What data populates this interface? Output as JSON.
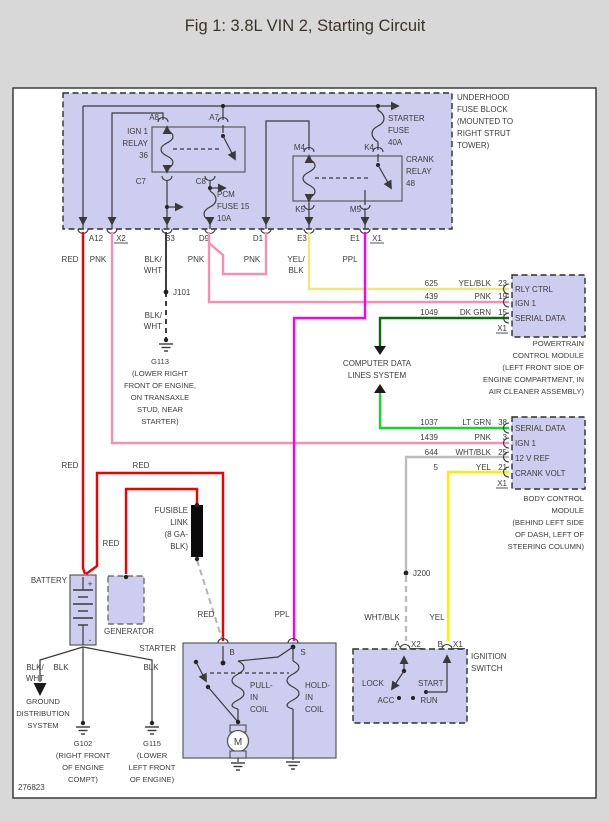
{
  "title": "Fig 1: 3.8L VIN 2, Starting Circuit",
  "doc_number": "276823",
  "colors": {
    "red": "#f20000",
    "pink": "#f78fb2",
    "magenta": "#fb00f0",
    "pale_yellow": "#efe878",
    "yellow": "#ffec00",
    "dark_green": "#0c6b0c",
    "light_green": "#15d42a",
    "white_black": "#bdbdbd",
    "black_wire": "#3d3d3d",
    "module_fill": "#cdcdf0"
  },
  "fuse_block": {
    "name_lines": [
      "UNDERHOOD",
      "FUSE BLOCK",
      "(MOUNTED TO",
      "RIGHT STRUT",
      "TOWER)"
    ],
    "ign1_relay": {
      "label_lines": [
        "IGN 1",
        "RELAY",
        "36"
      ],
      "pins": {
        "a8": "A8",
        "a7": "A7",
        "c7": "C7",
        "c8": "C8"
      }
    },
    "pcm_fuse_lines": [
      "PCM",
      "FUSE 15",
      "10A"
    ],
    "starter_fuse_lines": [
      "STARTER",
      "FUSE",
      "40A"
    ],
    "crank_relay": {
      "label_lines": [
        "CRANK",
        "RELAY",
        "48"
      ],
      "pins": {
        "m4": "M4",
        "k4": "K4",
        "k5": "K5",
        "m5": "M5"
      }
    },
    "terminals": [
      "A12",
      "X2",
      "B3",
      "D9",
      "D1",
      "E3",
      "E1",
      "X1"
    ],
    "wire_colors": {
      "a12": "RED",
      "x2": "PNK",
      "b3": [
        "BLK/",
        "WHT"
      ],
      "d9": "PNK",
      "d1": "PNK",
      "e3": [
        "YEL/",
        "BLK"
      ],
      "e1": "PPL"
    }
  },
  "grounds": {
    "j101": "J101",
    "b3_color_lines": [
      "BLK/",
      "WHT"
    ],
    "g113_lines": [
      "G113",
      "(LOWER RIGHT",
      "FRONT OF ENGINE,",
      "ON TRANSAXLE",
      "STUD, NEAR",
      "STARTER)"
    ],
    "g102_lines": [
      "G102",
      "(RIGHT FRONT",
      "OF ENGINE",
      "COMPT)"
    ],
    "g115_lines": [
      "G115",
      "(LOWER",
      "LEFT FRONT",
      "OF ENGINE)"
    ]
  },
  "pcm": {
    "pins": [
      {
        "circuit": "625",
        "color": "YEL/BLK",
        "pin": "23",
        "label": "RLY CTRL"
      },
      {
        "circuit": "439",
        "color": "PNK",
        "pin": "19",
        "label": "IGN 1"
      },
      {
        "circuit": "1049",
        "color": "DK GRN",
        "pin": "15",
        "label": "SERIAL DATA"
      }
    ],
    "connector": "X1",
    "name_lines": [
      "POWERTRAIN",
      "CONTROL MODULE",
      "(LEFT FRONT SIDE OF",
      "ENGINE COMPARTMENT, IN",
      "AIR CLEANER ASSEMBLY)"
    ]
  },
  "bcm": {
    "pins": [
      {
        "circuit": "1037",
        "color": "LT GRN",
        "pin": "38",
        "label": "SERIAL DATA"
      },
      {
        "circuit": "1439",
        "color": "PNK",
        "pin": "3",
        "label": "IGN 1"
      },
      {
        "circuit": "644",
        "color": "WHT/BLK",
        "pin": "25",
        "label": "12 V REF"
      },
      {
        "circuit": "5",
        "color": "YEL",
        "pin": "21",
        "label": "CRANK VOLT"
      }
    ],
    "connector": "X1",
    "name_lines": [
      "BODY CONTROL",
      "MODULE",
      "(BEHIND LEFT SIDE",
      "OF DASH, LEFT OF",
      "STEERING COLUMN)"
    ]
  },
  "computer_data_lines": [
    "COMPUTER DATA",
    "LINES SYSTEM"
  ],
  "power": {
    "battery": "BATTERY",
    "plus": "+",
    "minus": "-",
    "generator": "GENERATOR",
    "fusible_link_lines": [
      "FUSIBLE",
      "LINK",
      "(8 GA-",
      "BLK)"
    ],
    "red1": "RED",
    "red2": "RED",
    "red3": "RED",
    "red4": "RED"
  },
  "starter": {
    "label": "STARTER",
    "b": "B",
    "s": "S",
    "pull_in_lines": [
      "PULL-",
      "IN",
      "COIL"
    ],
    "hold_in_lines": [
      "HOLD-",
      "IN",
      "COIL"
    ],
    "motor": "M",
    "ppl": "PPL"
  },
  "ground_dist": {
    "blk_wht_lines": [
      "BLK/",
      "WHT"
    ],
    "blk1": "BLK",
    "blk2": "BLK",
    "system_lines": [
      "GROUND",
      "DISTRIBUTION",
      "SYSTEM"
    ]
  },
  "ignition": {
    "j200": "J200",
    "wht_blk": "WHT/BLK",
    "yel": "YEL",
    "a": "A",
    "x2": "X2",
    "b": "B",
    "x1": "X1",
    "label_lines": [
      "IGNITION",
      "SWITCH"
    ],
    "positions": {
      "lock": "LOCK",
      "start": "START",
      "acc": "ACC",
      "run": "RUN"
    }
  }
}
